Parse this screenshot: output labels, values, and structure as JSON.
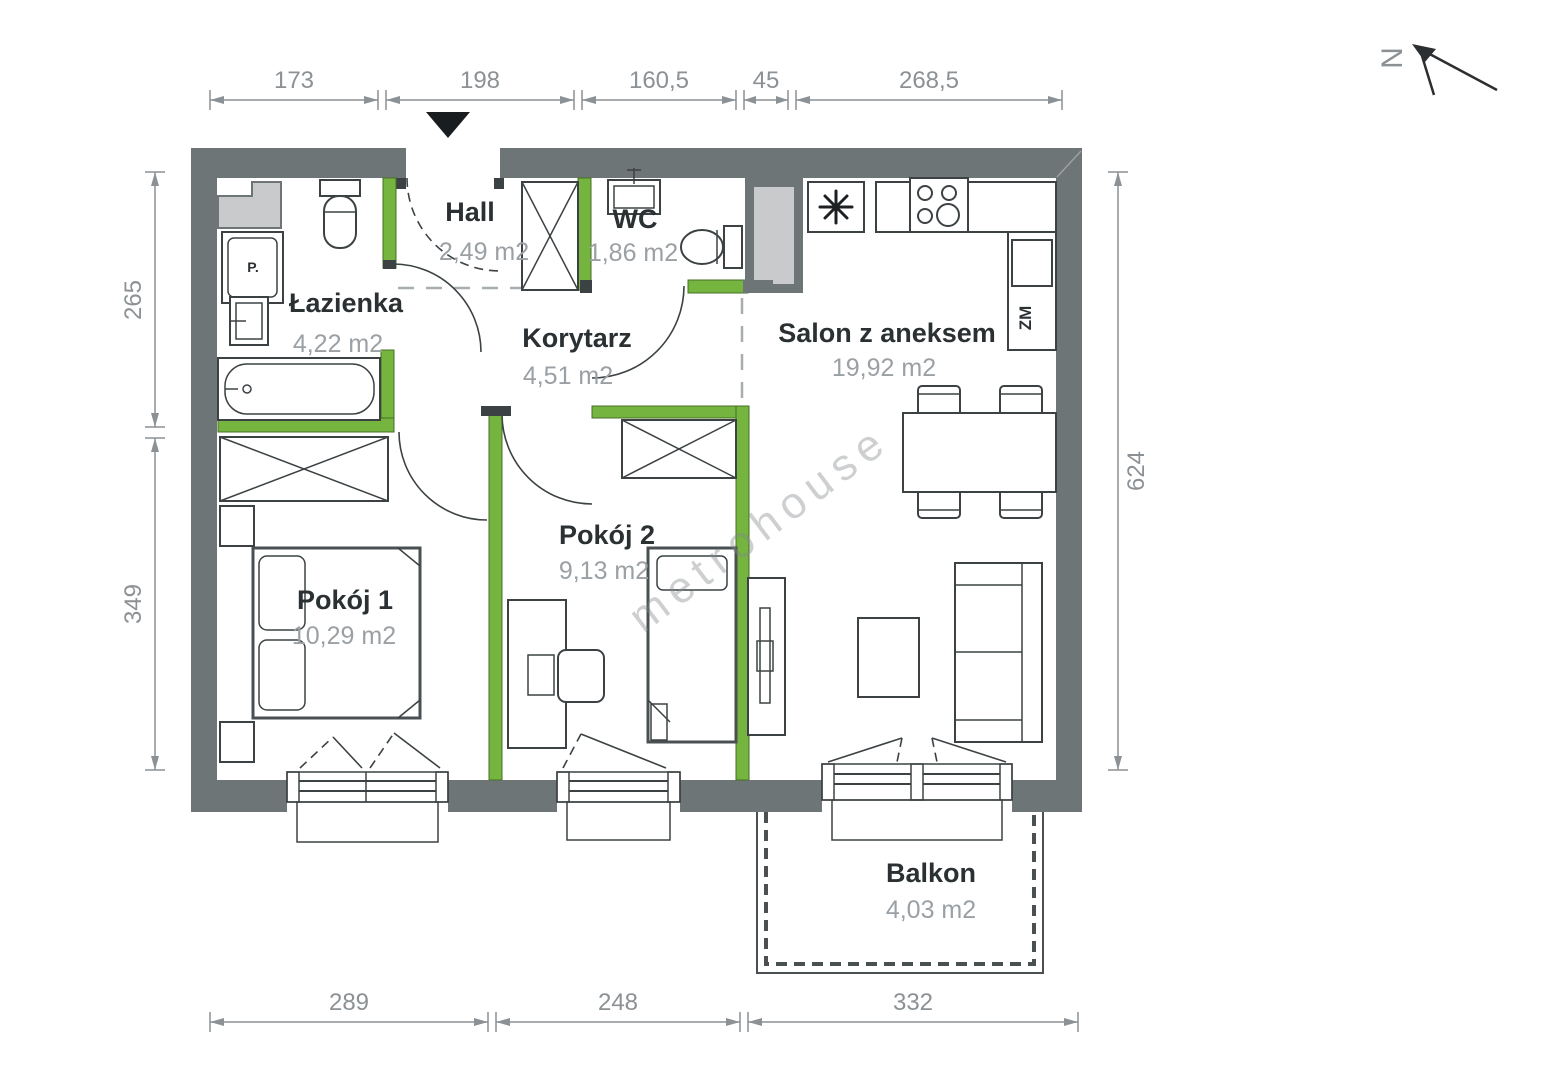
{
  "plan_title": "apartment-floor-plan",
  "rooms": {
    "hall": {
      "name": "Hall",
      "area": "2,49 m2"
    },
    "wc": {
      "name": "WC",
      "area": "1,86 m2"
    },
    "lazienka": {
      "name": "Łazienka",
      "area": "4,22 m2"
    },
    "korytarz": {
      "name": "Korytarz",
      "area": "4,51 m2"
    },
    "salon": {
      "name": "Salon z aneksem",
      "area": "19,92 m2"
    },
    "pokoj1": {
      "name": "Pokój 1",
      "area": "10,29 m2"
    },
    "pokoj2": {
      "name": "Pokój 2",
      "area": "9,13 m2"
    },
    "balkon": {
      "name": "Balkon",
      "area": "4,03 m2"
    }
  },
  "fixtures": {
    "washer": "P.",
    "dishwasher": "ZM"
  },
  "dimensions": {
    "top": [
      "173",
      "198",
      "160,5",
      "45",
      "268,5"
    ],
    "left": [
      "265",
      "349"
    ],
    "right": [
      "624"
    ],
    "bottom": [
      "289",
      "248",
      "332"
    ]
  },
  "north": {
    "label": "N"
  },
  "watermark": {
    "text": "metrohouse"
  },
  "colors": {
    "wall": "#6e7577",
    "wall_dark": "#3c4244",
    "partition": "#74b43f",
    "shaft": "#c8cacb",
    "dim": "#8b9194",
    "room_name": "#2b3033",
    "room_area": "#9aa0a4"
  }
}
